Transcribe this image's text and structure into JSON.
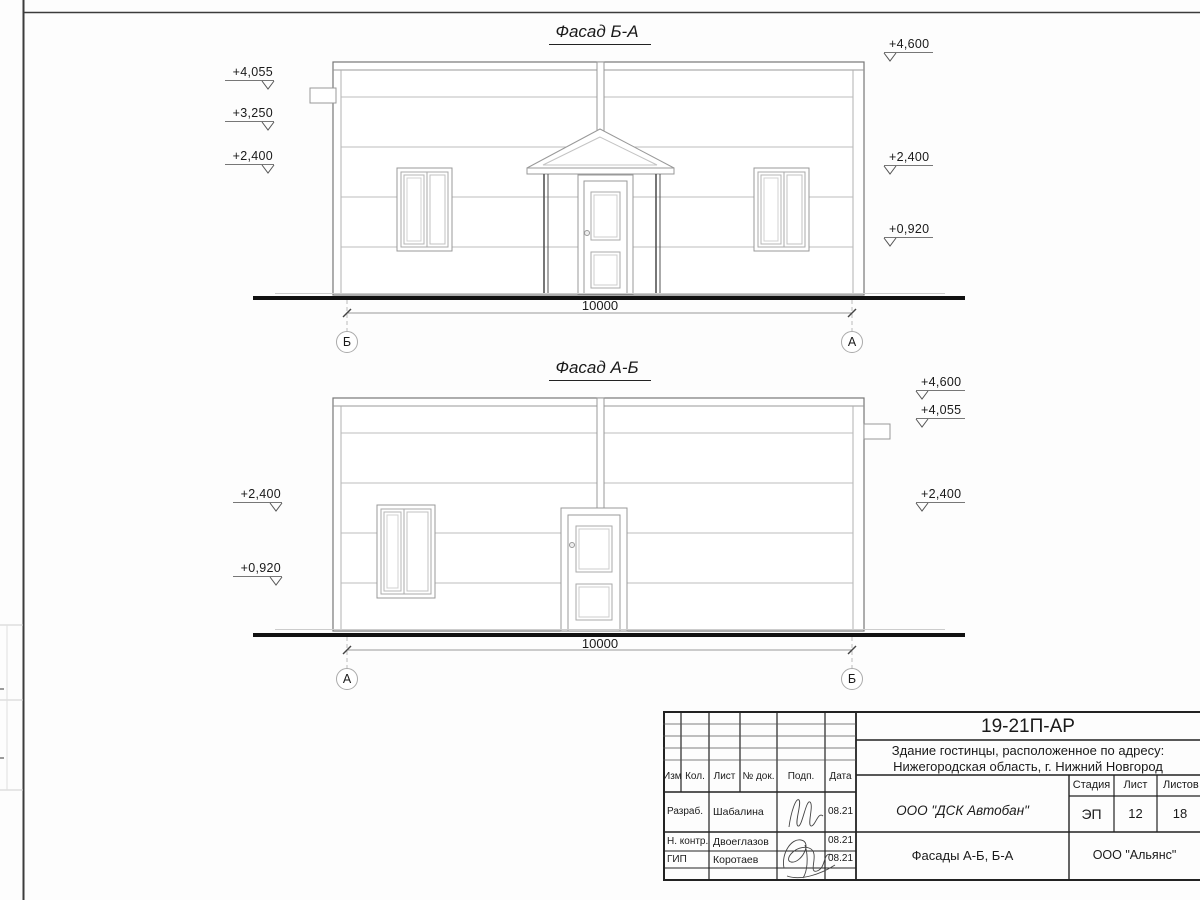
{
  "facade_ba": {
    "title": "Фасад Б-А",
    "dimension": "10000",
    "axis_left": "Б",
    "axis_right": "А",
    "marks_left": [
      "+4,055",
      "+3,250",
      "+2,400"
    ],
    "marks_right": [
      "+4,600",
      "+2,400",
      "+0,920"
    ]
  },
  "facade_ab": {
    "title": "Фасад А-Б",
    "dimension": "10000",
    "axis_left": "А",
    "axis_right": "Б",
    "marks_left": [
      "+2,400",
      "+0,920"
    ],
    "marks_right": [
      "+4,600",
      "+4,055",
      "+2,400"
    ]
  },
  "titleblock": {
    "doc_code": "19-21П-АР",
    "project_line1": "Здание гостинцы, расположенное по адресу:",
    "project_line2": "Нижегородская область, г. Нижний Новгород",
    "contractor": "ООО \"ДСК Автобан\"",
    "sheet_title": "Фасады А-Б, Б-А",
    "company": "ООО \"Альянс\"",
    "col_headers": [
      "Изм.",
      "Кол.",
      "Лист",
      "№ док.",
      "Подп.",
      "Дата"
    ],
    "stage_label": "Стадия",
    "sheet_label": "Лист",
    "sheets_label": "Листов",
    "stage_value": "ЭП",
    "sheet_value": "12",
    "sheets_value": "18",
    "rows": [
      {
        "role": "Разраб.",
        "name": "Шабалина",
        "date": "08.21"
      },
      {
        "role": "Н. контр.",
        "name": "Двоеглазов",
        "date": "08.21"
      },
      {
        "role": "ГИП",
        "name": "Коротаев",
        "date": "08.21"
      }
    ]
  },
  "colors": {
    "line_dark": "#1a1a1a",
    "line_medium": "#8a8a8a",
    "line_light": "#b8b8b8"
  }
}
